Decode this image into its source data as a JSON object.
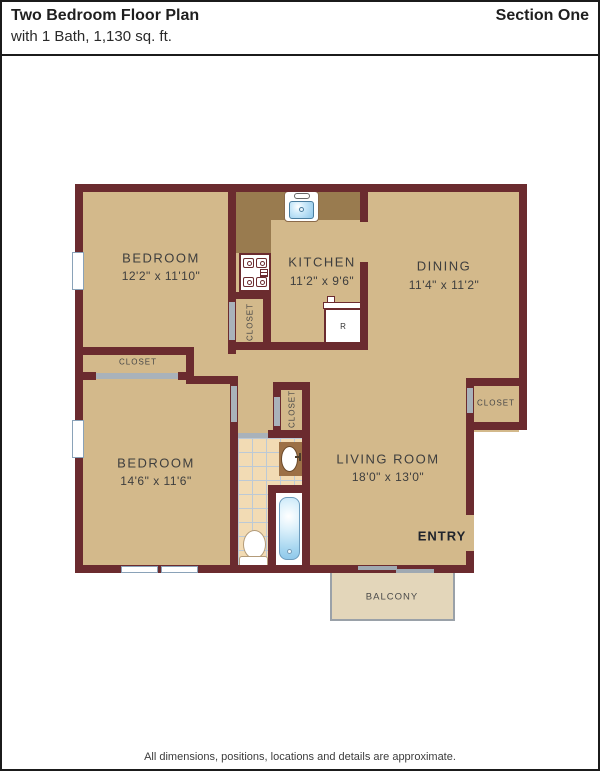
{
  "header": {
    "title": "Two Bedroom Floor Plan",
    "subtitle": "with 1 Bath, 1,130 sq. ft.",
    "section": "Section One"
  },
  "footer": {
    "disclaimer": "All dimensions, positions, locations and details are approximate."
  },
  "floorplan": {
    "rooms": [
      {
        "id": "bedroom-1",
        "name": "BEDROOM",
        "dims": "12'2\" x 11'10\""
      },
      {
        "id": "kitchen",
        "name": "KITCHEN",
        "dims": "11'2\" x 9'6\""
      },
      {
        "id": "dining",
        "name": "DINING",
        "dims": "11'4\" x 11'2\""
      },
      {
        "id": "bedroom-2",
        "name": "BEDROOM",
        "dims": "14'6\" x 11'6\""
      },
      {
        "id": "living-room",
        "name": "LIVING ROOM",
        "dims": "18'0\" x 13'0\""
      }
    ],
    "labels": {
      "closet": "CLOSET",
      "entry": "ENTRY",
      "balcony": "BALCONY",
      "refrigerator": "R"
    },
    "fixtures": [
      "kitchen-sink",
      "stove",
      "refrigerator",
      "bathroom-sink-vanity",
      "toilet",
      "bathtub"
    ],
    "colors": {
      "wall": "#6b2b2f",
      "floor": "#d3b98b",
      "counter": "#997b4f",
      "balcony_floor": "#e3d6ba",
      "tile": "#f2dbb4",
      "door_opening": "#a9b2ba",
      "water_blue": "#8ec7ea",
      "vanity_brown": "#9c7046",
      "text": "#3e3e3e"
    }
  }
}
